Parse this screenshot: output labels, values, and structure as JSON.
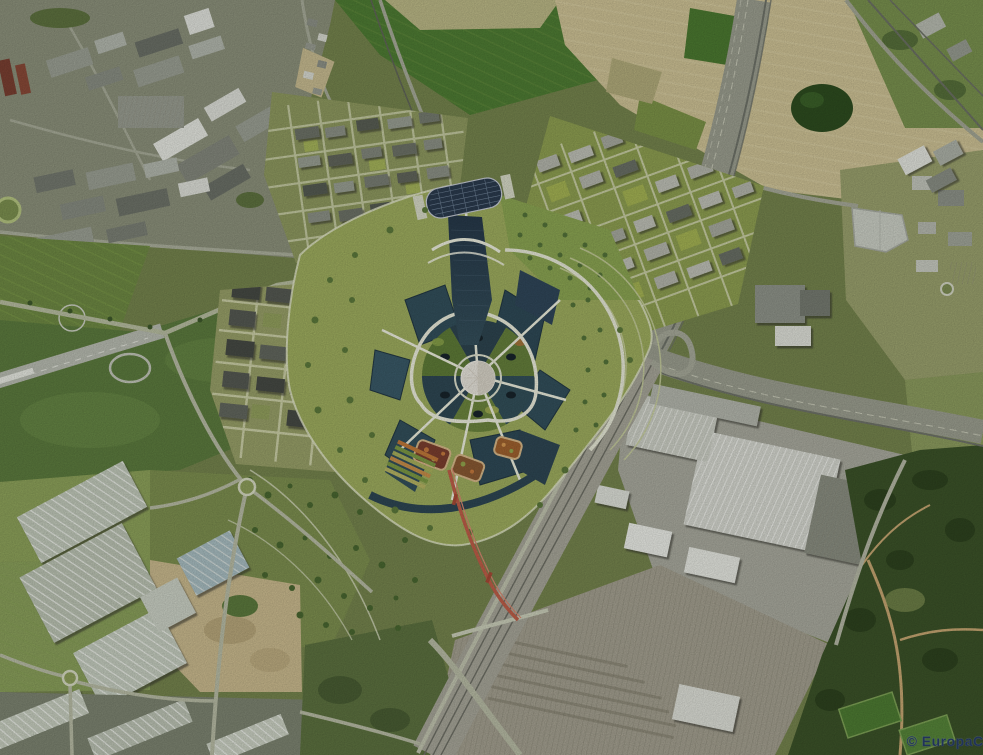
{
  "image": {
    "kind": "aerial-photo-with-masterplan-render",
    "width_px": 983,
    "height_px": 755
  },
  "watermark": {
    "text": "© EuropaCi",
    "color": "#20335a"
  },
  "palette": {
    "field_green": "#4f7d34",
    "field_tan": "#cfc396",
    "olive_base": "#76854e",
    "road_gray": "#9c9f90",
    "rail_dark": "#70746a",
    "glass_roof_dark": "#2e4550",
    "lake_slate": "#33505c",
    "path_white": "#edeedd",
    "dome_white": "#e8e5dc",
    "footbridge_red": "#bf5f49",
    "warehouse_roof": "#c2cabb",
    "forest_dark": "#3c5329",
    "dirt_tan": "#cbbb8f"
  },
  "regions": [
    {
      "name": "industrial-zone-northwest",
      "color": "#8d927c"
    },
    {
      "name": "farm-fields-north",
      "color": "#4f7d34"
    },
    {
      "name": "farm-fields-northeast-tan",
      "color": "#cfc396"
    },
    {
      "name": "forest-patch-northeast",
      "color": "#2e4d20"
    },
    {
      "name": "airfield-west",
      "color": "#5d7c3f"
    },
    {
      "name": "planned-district-northwest",
      "color": "#8f9a60"
    },
    {
      "name": "planned-district-northeast",
      "color": "#8fa052"
    },
    {
      "name": "planned-district-southwest",
      "color": "#99a169"
    },
    {
      "name": "central-masterplan-ring",
      "color": "#9fae5f"
    },
    {
      "name": "central-dome",
      "color": "#e8e5dc"
    },
    {
      "name": "highway-corridor-a1",
      "color": "#9c9f90"
    },
    {
      "name": "rail-corridor-south",
      "color": "#a8a79a"
    },
    {
      "name": "logistics-park-southwest",
      "color": "#c2cabb"
    },
    {
      "name": "factory-complex-southeast",
      "color": "#d6d8d0"
    },
    {
      "name": "forest-park-southeast",
      "color": "#3c5329"
    },
    {
      "name": "commercial-zone-east",
      "color": "#ccd0c6"
    },
    {
      "name": "red-footbridge",
      "color": "#bf5f49"
    }
  ]
}
